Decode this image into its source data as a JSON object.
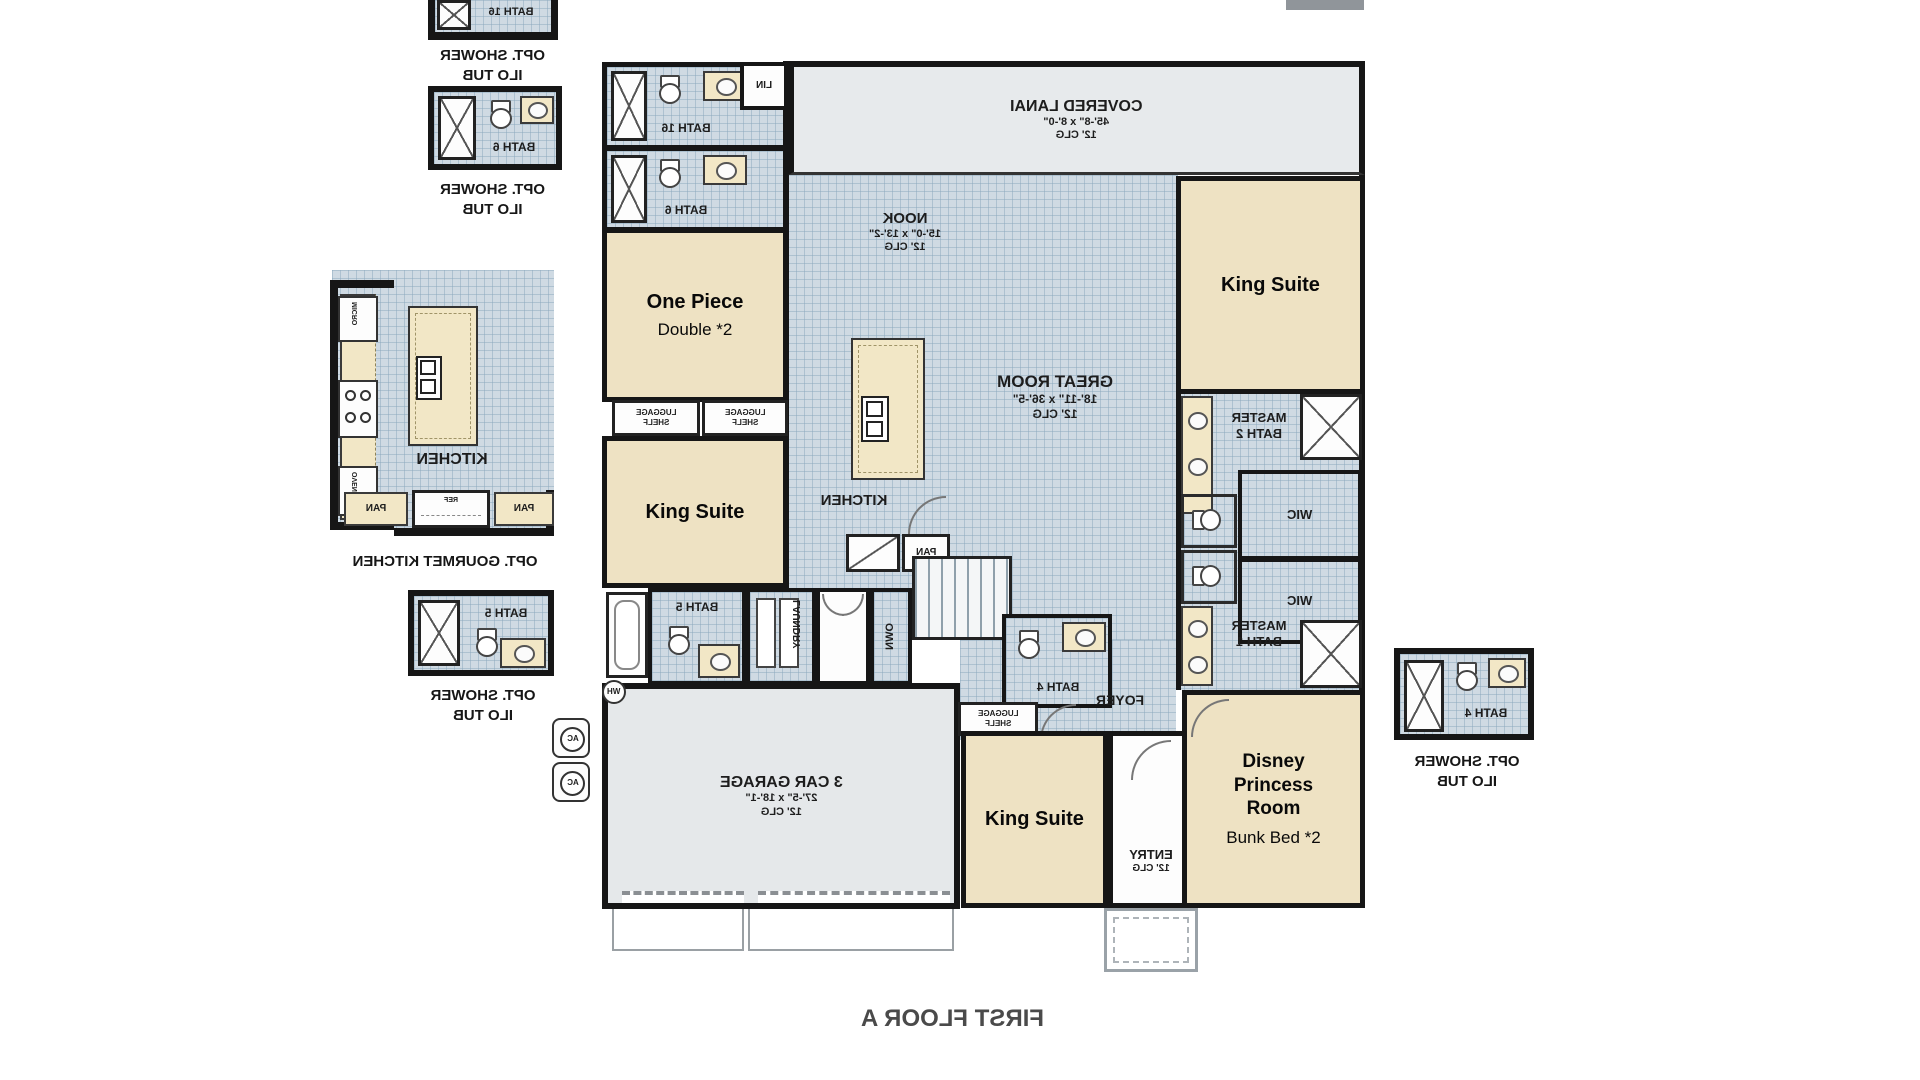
{
  "labels": {
    "opt_shower": "OPT. SHOWER",
    "ilo_tub": "ILO TUB",
    "opt_kitchen": "OPT. GOURMET KITCHEN",
    "first_floor": "FIRST FLOOR A"
  },
  "baths": {
    "b16": "BATH 16",
    "b6": "BATH 6",
    "b5": "BATH 5",
    "b4": "BATH 4"
  },
  "plan": {
    "lanai": {
      "name": "COVERED LANAI",
      "dims": "45'-8\" x 8'-0\"",
      "clg": "12' CLG"
    },
    "nook": {
      "name": "NOOK",
      "dims": "15'-0\" x 13'-2\"",
      "clg": "12' CLG"
    },
    "great": {
      "name": "GREAT ROOM",
      "dims": "18'-11\" x 36'-5\"",
      "clg": "12' CLG"
    },
    "garage": {
      "name": "3 CAR GARAGE",
      "dims": "27'-5\" x 18'-1\"",
      "clg": "12' CLG"
    },
    "entry": {
      "name": "ENTRY",
      "clg": "12' CLG"
    },
    "kitchen": "KITCHEN",
    "pan": "PAN",
    "lin": "LIN",
    "foyer": "FOYER",
    "laundry": "LAUNDRY",
    "own": "OWN",
    "wh": "WH",
    "ac": "AC",
    "ref": "REF",
    "micro": "MICRO",
    "oven": "OVEN",
    "luggage1": "LUGGAGE",
    "luggage2": "SHELF",
    "mb2": "MASTER BATH 2",
    "mb1": "MASTER BATH 1",
    "wic": "WIC"
  },
  "rooms": {
    "one_piece": {
      "title": "One Piece",
      "subtitle": "Double *2"
    },
    "king": "King Suite",
    "princess": {
      "l1": "Disney",
      "l2": "Princess",
      "l3": "Room",
      "subtitle": "Bunk Bed *2"
    }
  }
}
